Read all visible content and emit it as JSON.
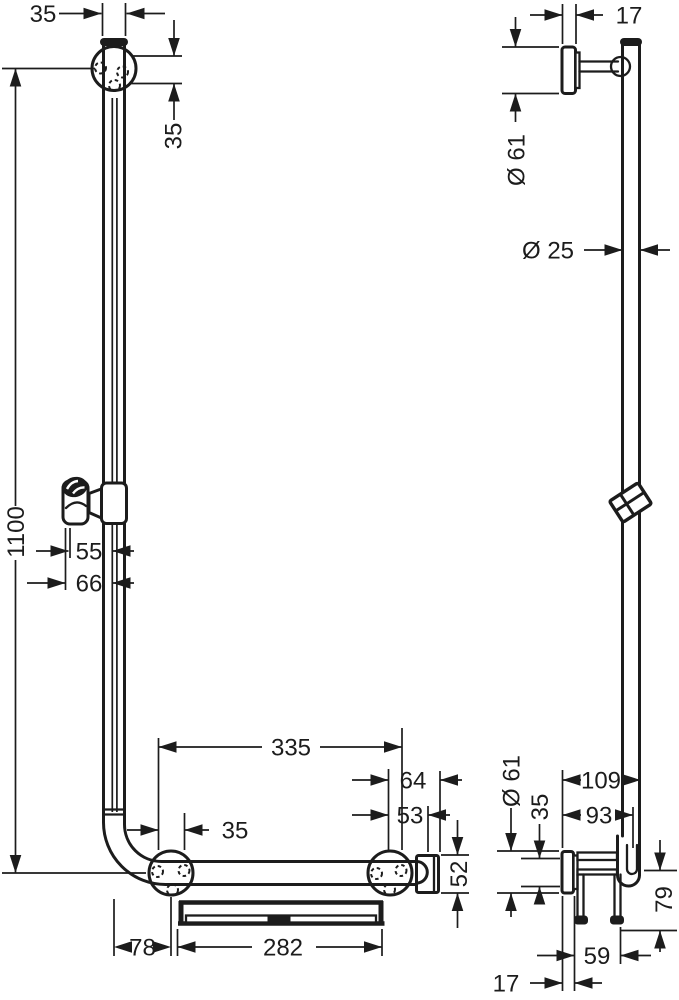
{
  "drawing": {
    "background": "#ffffff",
    "line_color": "#1c1c1c",
    "front_view": {
      "name": "front view",
      "dims": {
        "bar_width": "35",
        "top_overhang": "35",
        "total_height": "1100",
        "holder_offset": "55",
        "holder_outer_offset": "66",
        "lower_mount_span": "335",
        "mount_to_end_outer": "64",
        "mount_to_end_inner": "53",
        "mount_hole_span": "35",
        "end_holder_height": "52",
        "shelf_width": "282",
        "bar_to_mount": "78"
      }
    },
    "side_view": {
      "name": "side view",
      "dims": {
        "top_plate_depth": "17",
        "top_plate_diameter": "Ø 61",
        "bar_diameter": "Ø 25",
        "wall_to_bar_outer": "109",
        "wall_to_bar_center": "93",
        "bottom_plate_diameter": "Ø 61",
        "bar_profile_height": "35",
        "bar_to_shelf_drop": "79",
        "shelf_depth": "59",
        "bottom_plate_depth": "17"
      }
    }
  }
}
